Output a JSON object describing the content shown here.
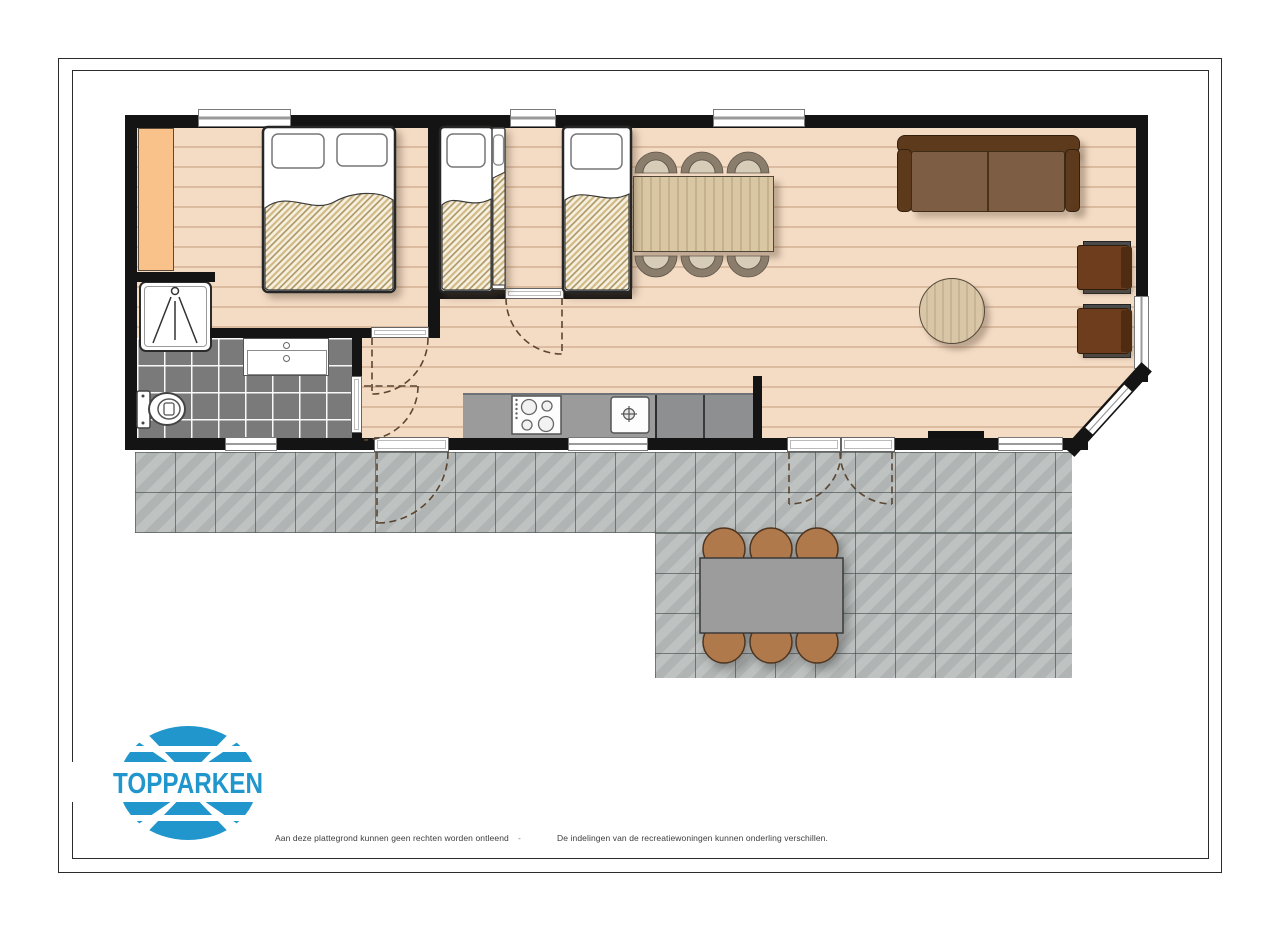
{
  "logo": {
    "text": "TOPPARKEN",
    "color": "#2096cd"
  },
  "footer": {
    "left": "Aan deze plattegrond kunnen geen rechten worden ontleend",
    "separator": "-",
    "right": "De indelingen van de recreatiewoningen kunnen onderling verschillen."
  },
  "colors": {
    "wall": "#141414",
    "wood_floor": "#f3dbc4",
    "bathroom_tile": "#7a7a7a",
    "terrace_tile": "#b9bdbc",
    "wardrobe_orange": "#f9c28b",
    "sofa_frame": "#5e3a1c",
    "sofa_cushion": "#7d5d43",
    "armchair": "#6e3d1e",
    "dining_wood": "#d9c7a3",
    "terrace_chair": "#b0794c",
    "terrace_table": "#9c9c9c",
    "kitchen_counter": "#9b9b9b",
    "logo_blue": "#2096cd"
  }
}
